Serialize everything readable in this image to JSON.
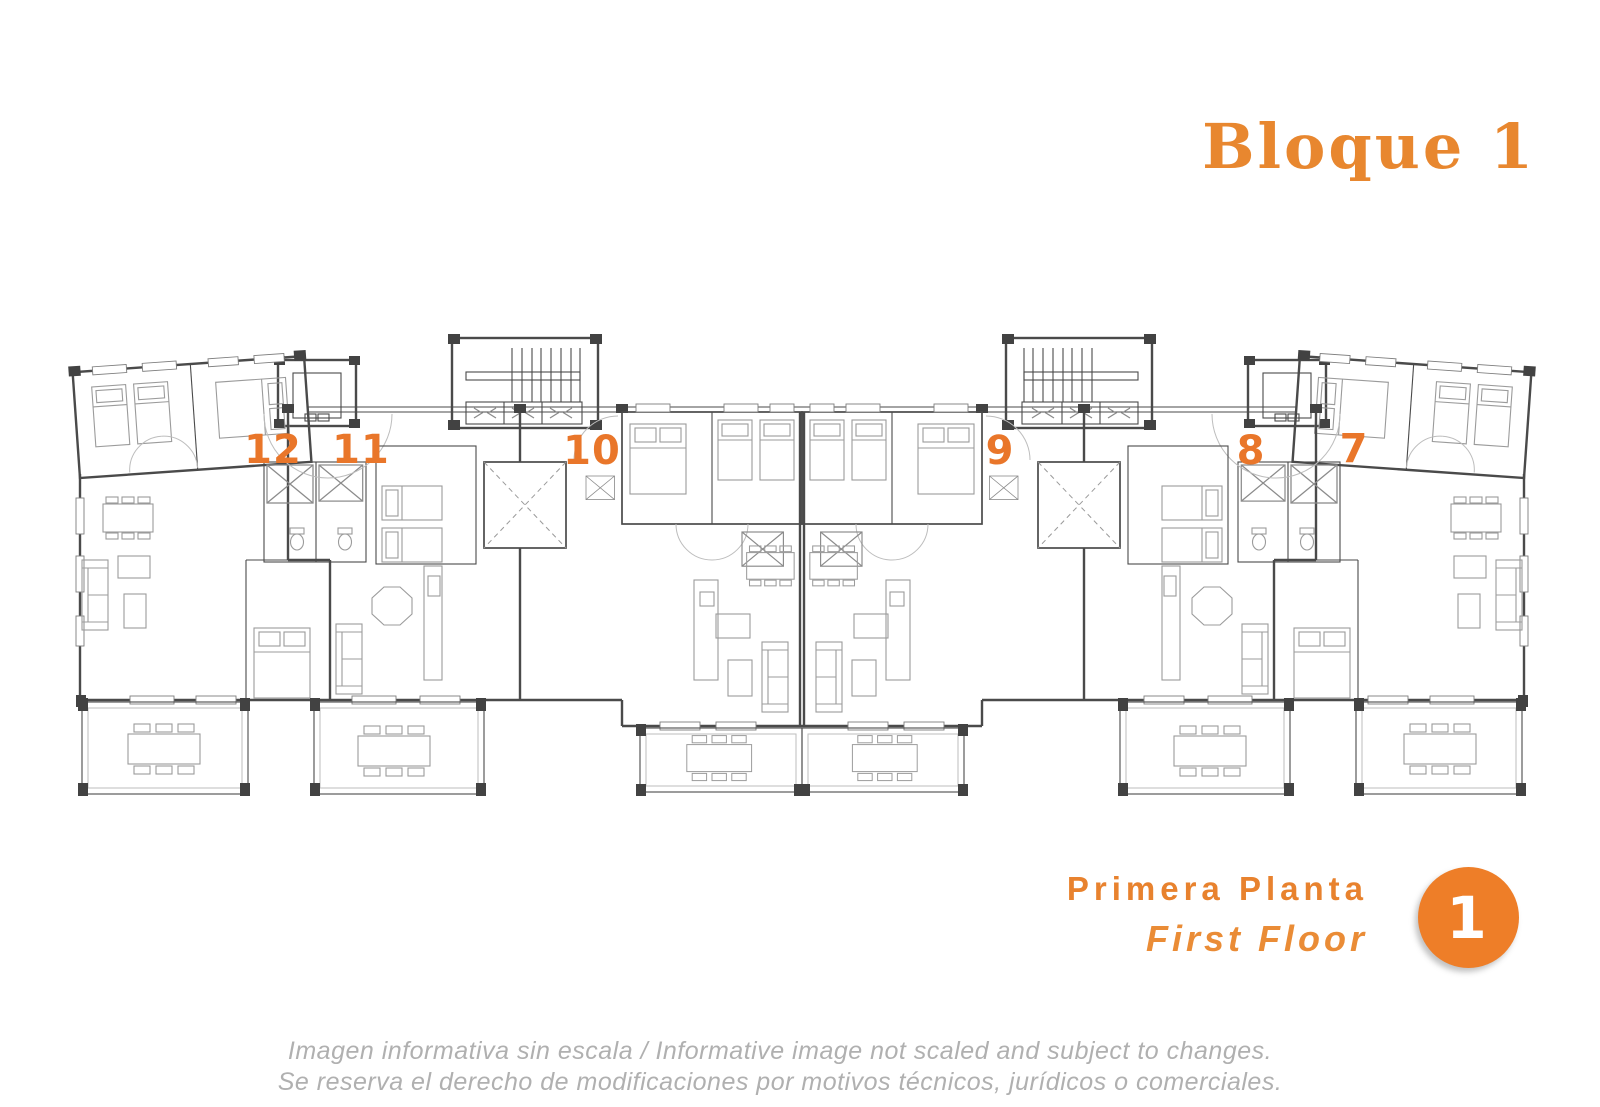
{
  "header": {
    "title": "Bloque 1"
  },
  "plan": {
    "units": [
      {
        "label": "12"
      },
      {
        "label": "11"
      },
      {
        "label": "10"
      },
      {
        "label": "9"
      },
      {
        "label": "8"
      },
      {
        "label": "7"
      }
    ]
  },
  "floor_info": {
    "name_es": "Primera Planta",
    "name_en": "First Floor",
    "number": "1"
  },
  "disclaimer": {
    "line1": "Imagen informativa sin escala /  Informative image not scaled and subject to changes.",
    "line2": "Se reserva el derecho de modificaciones por motivos técnicos, jurídicos o comerciales."
  },
  "colors": {
    "accent_orange": "#e9762a",
    "title_orange": "#e8872f",
    "badge_orange": "#ee7e28",
    "muted_gray": "#b0b0b0",
    "wall_gray": "#4a4a4a",
    "furniture_gray": "#9b9b9b"
  }
}
